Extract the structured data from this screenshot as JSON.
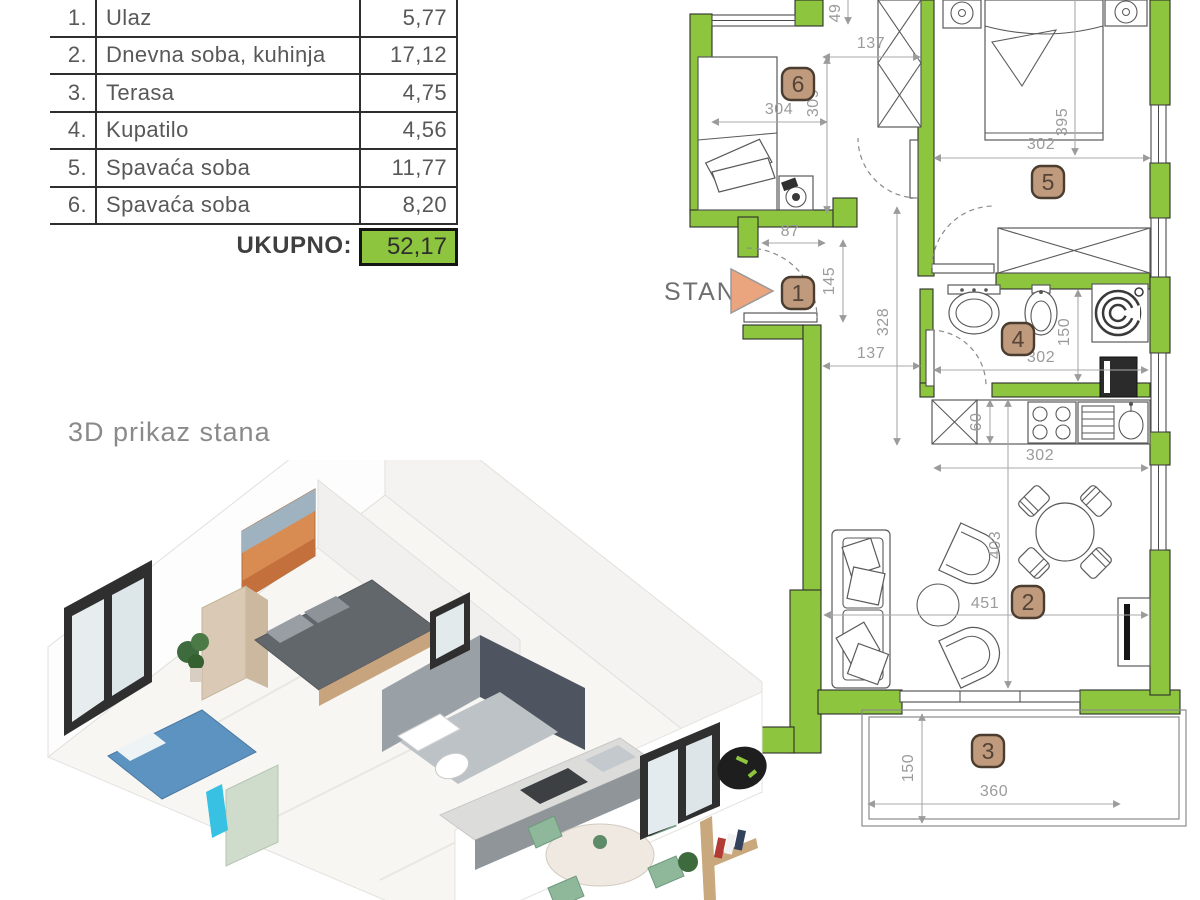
{
  "table": {
    "rows": [
      {
        "num": "1.",
        "name": "Ulaz",
        "value": "5,77"
      },
      {
        "num": "2.",
        "name": "Dnevna soba, kuhinja",
        "value": "17,12"
      },
      {
        "num": "3.",
        "name": "Terasa",
        "value": "4,75"
      },
      {
        "num": "4.",
        "name": "Kupatilo",
        "value": "4,56"
      },
      {
        "num": "5.",
        "name": "Spavaća soba",
        "value": "11,77"
      },
      {
        "num": "6.",
        "name": "Spavaća soba",
        "value": "8,20"
      }
    ],
    "total_label": "UKUPNO:",
    "total_value": "52,17"
  },
  "plan": {
    "unit_label": "STAN 1",
    "badges": {
      "b1": "1",
      "b2": "2",
      "b3": "3",
      "b4": "4",
      "b5": "5",
      "b6": "6"
    },
    "dims": {
      "top137": "137",
      "v309": "309",
      "h304": "304",
      "v49": "49",
      "r5_302": "302",
      "v395": "395",
      "h87": "87",
      "v145": "145",
      "v328": "328",
      "hall137": "137",
      "bath150": "150",
      "bath302": "302",
      "k60": "60",
      "k302": "302",
      "v403": "403",
      "h451": "451",
      "terr150": "150",
      "terr360": "360"
    }
  },
  "render3d": {
    "title": "3D prikaz stana"
  },
  "colors": {
    "wall_green": "#8dc63e",
    "badge_fill": "#bf9a7d",
    "triangle": "#eaa57e",
    "total_green": "#8dc63e"
  }
}
